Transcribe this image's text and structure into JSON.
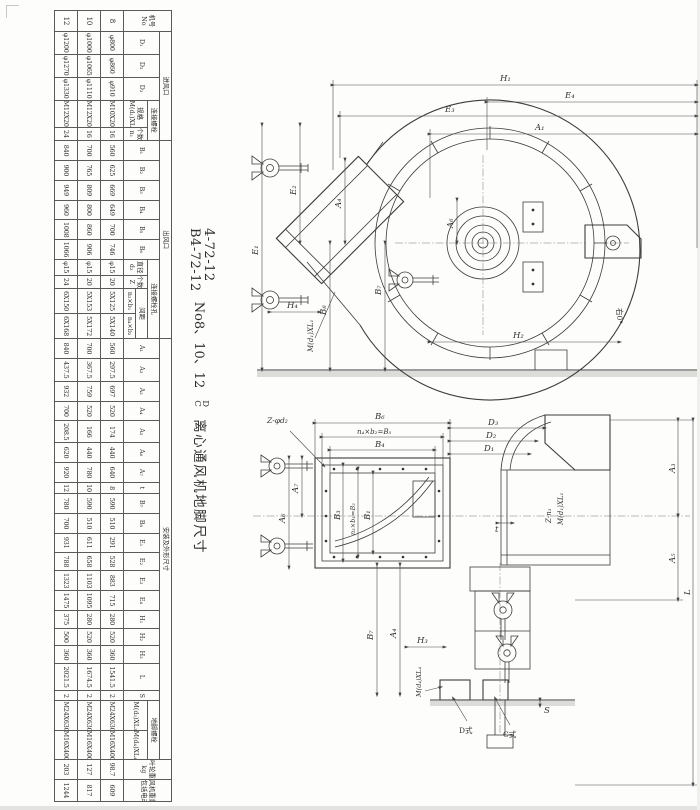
{
  "title": {
    "model_line1": "4-72-12",
    "model_line2": "B4-72-12",
    "size_note": "No8、10、12",
    "type_top": "D",
    "type_bottom": "C",
    "suffix": "离心通风机地脚尺寸"
  },
  "table": {
    "header_rows": [
      [
        {
          "t": "机号",
          "t2": "No",
          "rs": 4
        },
        {
          "t": "进风口",
          "cs": 5
        },
        {
          "t": "出风口",
          "cs": 10
        },
        {
          "t": "安装及外形尺寸",
          "cs": 21
        },
        {
          "t": "叶轮重量",
          "t2": "kg",
          "rs": 4
        },
        {
          "t": "风机重量(不",
          "t2": "包括电动机)kg",
          "rs": 4
        }
      ],
      [
        {
          "t": "D₁",
          "rs": 3
        },
        {
          "t": "D₂",
          "rs": 3
        },
        {
          "t": "D₃",
          "rs": 3
        },
        {
          "t": "连接螺栓",
          "cs": 2
        },
        {
          "t": "B₁",
          "rs": 3
        },
        {
          "t": "B₂",
          "rs": 3
        },
        {
          "t": "B₃",
          "rs": 3
        },
        {
          "t": "B₄",
          "rs": 3
        },
        {
          "t": "B₅",
          "rs": 3
        },
        {
          "t": "B₆",
          "rs": 3
        },
        {
          "t": "连接螺栓孔",
          "cs": 4
        },
        {
          "t": "A₁",
          "rs": 3
        },
        {
          "t": "A₂",
          "rs": 3
        },
        {
          "t": "A₃",
          "rs": 3
        },
        {
          "t": "A₄",
          "rs": 3
        },
        {
          "t": "A₅",
          "rs": 3
        },
        {
          "t": "A₆",
          "rs": 3
        },
        {
          "t": "A₇",
          "rs": 3
        },
        {
          "t": "t",
          "rs": 3
        },
        {
          "t": "B₇",
          "rs": 3
        },
        {
          "t": "B₈",
          "rs": 3
        },
        {
          "t": "E₁",
          "rs": 3
        },
        {
          "t": "E₂",
          "rs": 3
        },
        {
          "t": "E₃",
          "rs": 3
        },
        {
          "t": "E₄",
          "rs": 3
        },
        {
          "t": "H₁",
          "rs": 3
        },
        {
          "t": "H₂",
          "rs": 3
        },
        {
          "t": "H₃",
          "rs": 3
        },
        {
          "t": "L",
          "rs": 3
        },
        {
          "t": "S",
          "rs": 3
        },
        {
          "t": "地脚螺栓",
          "cs": 2
        }
      ],
      [
        {
          "t": "规格",
          "t2": "M(d₁)XL₁",
          "rs": 2
        },
        {
          "t": "个数",
          "t2": "n₁",
          "rs": 2
        },
        {
          "t": "直径",
          "t2": "d₂",
          "rs": 2
        },
        {
          "t": "个数",
          "t2": "Z",
          "rs": 2
        },
        {
          "t": "间距",
          "cs": 2
        },
        {
          "t": "M(d₃)XL₃",
          "rs": 2
        },
        {
          "t": "M(d₄)XL₄",
          "rs": 2
        }
      ],
      [
        {
          "t": "n₃×b₁"
        },
        {
          "t": "n₄×b₂"
        }
      ]
    ],
    "rows": [
      {
        "no": "8",
        "values": [
          "φ800",
          "φ860",
          "φ910",
          "M10X20",
          "16",
          "560",
          "625",
          "669",
          "649",
          "700",
          "746",
          "φ15",
          "20",
          "5X125",
          "5X140",
          "560",
          "297.5",
          "697",
          "520",
          "174",
          "440",
          "640",
          "8",
          "590",
          "510",
          "291",
          "528",
          "883",
          "715",
          "280",
          "520",
          "360",
          "1541.5",
          "2",
          "M24X630",
          "M16X400",
          "98.7",
          "609"
        ]
      },
      {
        "no": "10",
        "values": [
          "φ1000",
          "φ1065",
          "φ1110",
          "M12X20",
          "16",
          "700",
          "765",
          "809",
          "800",
          "860",
          "906",
          "φ15",
          "20",
          "5X153",
          "5X172",
          "700",
          "367.5",
          "759",
          "520",
          "166",
          "440",
          "780",
          "10",
          "590",
          "510",
          "611",
          "658",
          "1103",
          "1095",
          "280",
          "520",
          "360",
          "1674.5",
          "2",
          "M24X630",
          "M16X400",
          "127",
          "817"
        ]
      },
      {
        "no": "12",
        "values": [
          "φ1200",
          "φ1270",
          "φ1330",
          "M12X20",
          "24",
          "840",
          "900",
          "949",
          "960",
          "1008",
          "1066",
          "φ15",
          "24",
          "6X150",
          "6X168",
          "840",
          "437.5",
          "932",
          "700",
          "208.5",
          "620",
          "920",
          "12",
          "780",
          "700",
          "931",
          "788",
          "1323",
          "1475",
          "375",
          "500",
          "360",
          "2021.5",
          "2",
          "M24X630",
          "M16X400",
          "203",
          "1244"
        ]
      }
    ]
  },
  "front_view": {
    "labels": {
      "h1": "H₁",
      "e4": "E₄",
      "e3": "E₃",
      "a1": "A₁",
      "e1": "E₁",
      "e2": "E₂",
      "a4": "A₄",
      "b8": "B₈",
      "b7": "B₇",
      "a6": "A₆",
      "h4": "H₄",
      "h2": "H₂",
      "bolt1": "M(d₁)XL₁",
      "angle": "右0°"
    }
  },
  "side_view": {
    "labels": {
      "b6": "B₆",
      "b5": "n₄×b₂=B₅",
      "b4": "B₄",
      "zd": "Z-φd₂",
      "d3": "D₃",
      "d2": "D₂",
      "d1": "D₁",
      "bolt1": "M(d₁)XL₁",
      "zn": "Z-n₁",
      "t": "t",
      "a7": "A₇",
      "a6": "A₆",
      "b3": "B₃",
      "b2": "n₃×b₁=B₂",
      "b1": "B₁",
      "a3": "A₃",
      "a5": "A₅",
      "l": "L",
      "b7": "B₇",
      "a4": "A₄",
      "h3": "H₃",
      "bolt4": "M(d₄)XL₄",
      "dtype": "D式",
      "ctype": "C式",
      "s": "S"
    }
  }
}
